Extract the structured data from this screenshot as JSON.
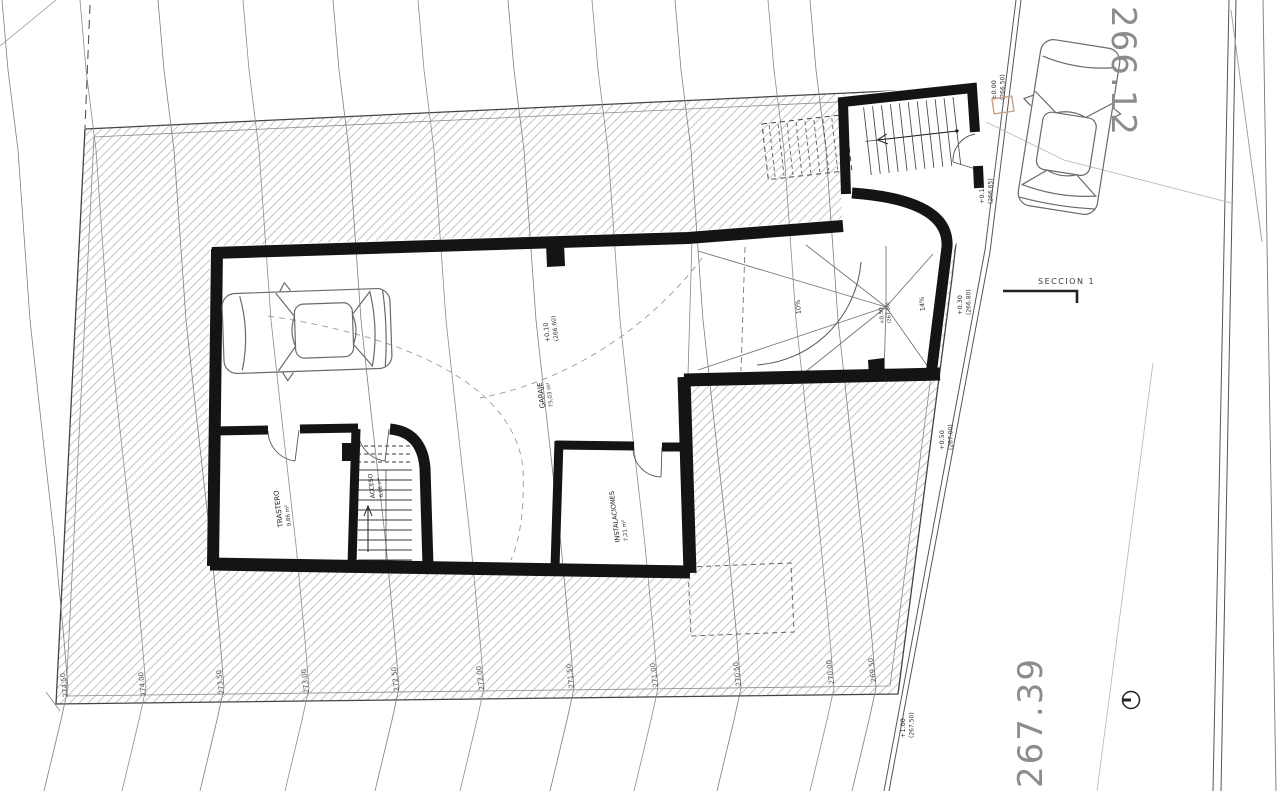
{
  "page": {
    "background": "#ffffff"
  },
  "plan": {
    "rooms": [
      {
        "name": "GARAJE",
        "area": "75,03 m²"
      },
      {
        "name": "TRASTERO",
        "area": "9,86 m²"
      },
      {
        "name": "ACCESO",
        "area": "6,88 m²"
      },
      {
        "name": "INSTALACIONES",
        "area": "7,21 m²"
      }
    ],
    "room_elevation": {
      "value": "+0.10",
      "datum": "(266.60)"
    },
    "ramp": {
      "slopes": [
        "10%",
        "14%"
      ],
      "elevation": {
        "value": "+0.50",
        "datum": "(267.00)"
      }
    },
    "street_elevations": [
      {
        "value": "±0.00",
        "datum": "(266.50)"
      },
      {
        "value": "+0.15",
        "datum": "(266.65)"
      },
      {
        "value": "+0.30",
        "datum": "(266.80)"
      },
      {
        "value": "+0.50",
        "datum": "(267.00)"
      },
      {
        "value": "+1.00",
        "datum": "(267.50)"
      }
    ],
    "street_levels": {
      "top": "266.12",
      "bottom": "267.39"
    },
    "section_marker": "SECCION 1",
    "contour_labels": [
      "274.50",
      "274.00",
      "273.50",
      "273.00",
      "272.50",
      "272.00",
      "271.50",
      "271.00",
      "270.50",
      "270.00",
      "269.50"
    ],
    "accent_color": "#c9a081"
  }
}
